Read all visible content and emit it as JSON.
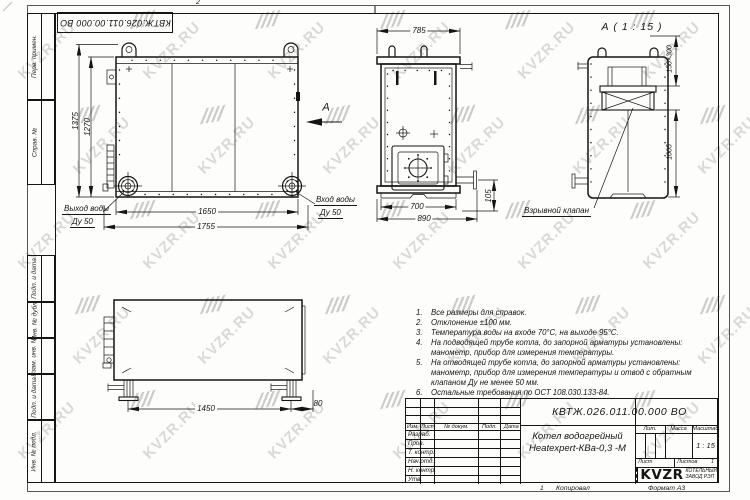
{
  "frame": {
    "zone_top": "2",
    "stamp": "КВТЖ.026.011.00.000 ВО",
    "margin_labels": [
      "Перв. примен.",
      "Справ. №",
      "Подп. и дата",
      "Инв. № дубл.",
      "Взам. инв. №",
      "Подп. и дата",
      "Инв. № подл."
    ]
  },
  "views": {
    "front": {
      "dim_height_overall": "1375",
      "dim_height_body": "1270",
      "dim_width_body": "1650",
      "dim_width_overall": "1755",
      "outlet_label": "Выход воды",
      "outlet_dn": "Ду 50",
      "inlet_label": "Вход воды",
      "inlet_dn": "Ду 50",
      "view_arrow_label": "А"
    },
    "side": {
      "dim_top": "785",
      "dim_body": "700",
      "dim_overall": "890",
      "dim_pipe": "105"
    },
    "section": {
      "title": "А ( 1 : 15 )",
      "dim_valve": "150×300",
      "dim_height": "1005",
      "valve_label": "Взрывной клапан"
    },
    "bottom": {
      "dim_feet": "1450",
      "dim_offset": "80"
    }
  },
  "notes": {
    "lines": [
      {
        "num": "1.",
        "text": "Все размеры для справок."
      },
      {
        "num": "2.",
        "text": "Отклонение ±100 мм."
      },
      {
        "num": "3.",
        "text": "Температура воды на входе 70°С, на выходе 95°С."
      },
      {
        "num": "4.",
        "text": "На подводящей трубе котла, до запорной арматуры установлены:"
      },
      {
        "num": "",
        "text": "манометр, прибор для измерения температуры."
      },
      {
        "num": "5.",
        "text": "На отводящей трубе котла, до запорной арматуры установлены:"
      },
      {
        "num": "",
        "text": "манометр, прибор для измерения температуры и отвод с обратным"
      },
      {
        "num": "",
        "text": "клапаном Ду не менее 50 мм."
      },
      {
        "num": "6.",
        "text": "Остальные требования по ОСТ 108.030.133-84."
      }
    ]
  },
  "title_block": {
    "designation": "КВТЖ.026.011.00.000 ВО",
    "name_line1": "Котел водогрейный",
    "name_line2": "Heatexpert-КВа-0,3 -М",
    "rev_headers": [
      "Изм.",
      "Лист",
      "№ докум.",
      "Подп.",
      "Дата"
    ],
    "sig_rows": [
      "Разраб.",
      "Пров.",
      "Т. контр.",
      "Нач.отд.",
      "Н. контр.",
      "Утв."
    ],
    "lit_label": "Лит.",
    "mass_label": "Масса",
    "scale_label": "Масштаб",
    "scale_value": "1 : 15",
    "sheet_label": "Лист",
    "sheets_label": "Листов",
    "sheets_value": "1",
    "org_logo": "KVZR",
    "org_name_line1": "КОТЕЛЬНЫЙ",
    "org_name_line2": "ЗАВОД РЭП",
    "copy_num": "1",
    "copied_label": "Копировал",
    "format_label": "Формат А3"
  },
  "watermark": {
    "text": "KVZR.RU",
    "color": "#d9d9d8",
    "mark_color": "#cccccb"
  }
}
